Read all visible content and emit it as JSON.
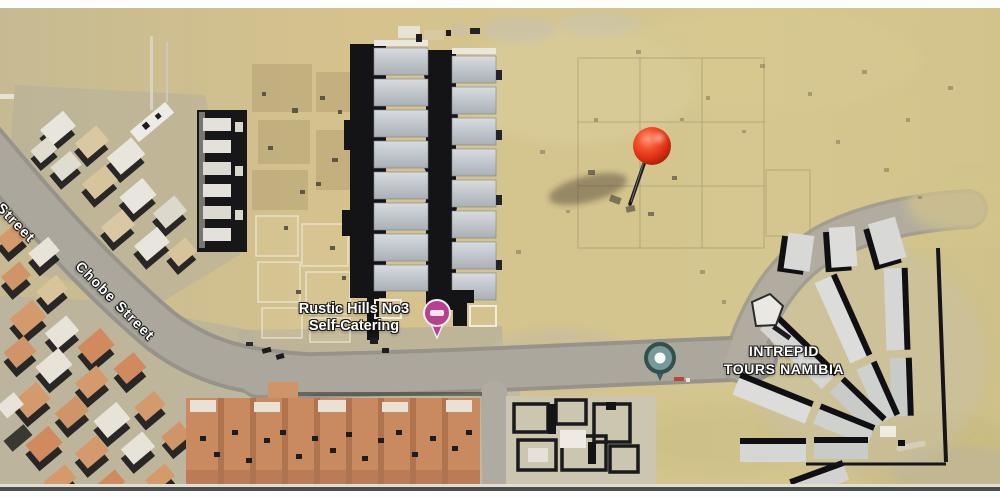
{
  "map": {
    "type": "satellite-map-photo",
    "street_labels": {
      "partial": "e Street",
      "chobe": "Chobe Street"
    },
    "pois": {
      "rustic": {
        "line1": "Rustic Hills No3",
        "line2": "Self-Catering",
        "pin_icon": "lodging-pin",
        "pin_color": "#b5418f"
      },
      "intrepid": {
        "line1": "INTREPID",
        "line2": "TOURS NAMIBIA",
        "pin_icon": "tours-pin",
        "pin_color": "#76999a"
      }
    },
    "marker": {
      "icon": "red-pushpin",
      "color": "#e03818"
    },
    "colors": {
      "sand": "#d2c08c",
      "road": "#aba79d",
      "ground_gray": "#b5b0a2",
      "roof_gray": "#d3d7dc",
      "roof_orange": "#d08a5e",
      "shadow": "#16161a",
      "pin_red": "#e03818",
      "pin_magenta": "#b5418f",
      "pin_teal": "#33504f",
      "label": "#ffffff",
      "border_white": "#fdfdfc",
      "divider": "#4a4f52"
    }
  }
}
